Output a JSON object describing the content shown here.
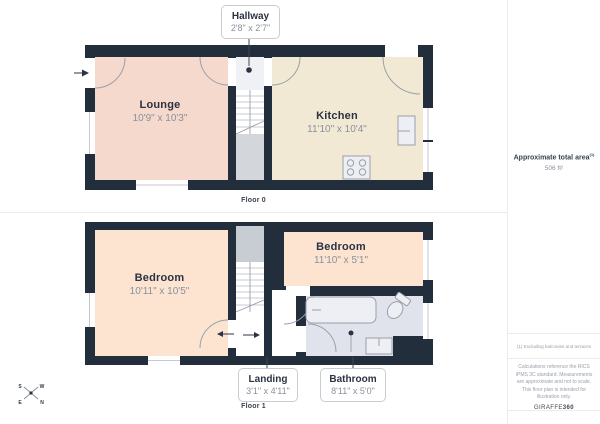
{
  "floor0": {
    "label": "Floor 0",
    "lounge": {
      "name": "Lounge",
      "dims": "10'9\" x 10'3\""
    },
    "kitchen": {
      "name": "Kitchen",
      "dims": "11'10\" x 10'4\""
    },
    "hallway": {
      "name": "Hallway",
      "dims": "2'8\" x 2'7\""
    }
  },
  "floor1": {
    "label": "Floor 1",
    "bedroom_left": {
      "name": "Bedroom",
      "dims": "10'11\" x 10'5\""
    },
    "bedroom_right": {
      "name": "Bedroom",
      "dims": "11'10\" x 5'1\""
    },
    "landing": {
      "name": "Landing",
      "dims": "3'1\" x 4'11\""
    },
    "bathroom": {
      "name": "Bathroom",
      "dims": "8'11\" x 5'0\""
    }
  },
  "sidebar": {
    "area_title": "Approximate total area",
    "area_superscript": "(1)",
    "area_value": "506 ft²",
    "footnote": "(1) Excluding balconies and terraces",
    "disclaimer": "Calculations reference the RICS IPMS 3C standard. Measurements are approximate and not to scale. This floor plan is intended for illustration only.",
    "logo_text": "GIRAFFE",
    "logo_suffix": "360"
  },
  "compass": {
    "s": "S",
    "w": "W",
    "e": "E",
    "n": "N"
  },
  "colors": {
    "wall": "#232e3c",
    "lounge": "#f5d9cd",
    "kitchen": "#f2e9d5",
    "bedroom": "#fce4d1",
    "bathroom": "#e0e3ec",
    "hallway_floor": "#eff1f4",
    "stair_gray": "#d3d6da",
    "stair_gray2": "#c8ccd3",
    "fixture_fill": "#edeff5",
    "line_gray": "#9aa0a8",
    "text_dark": "#2b3342",
    "text_gray": "#8a909b",
    "leader": "#3d4654",
    "border_light": "#ececec"
  }
}
